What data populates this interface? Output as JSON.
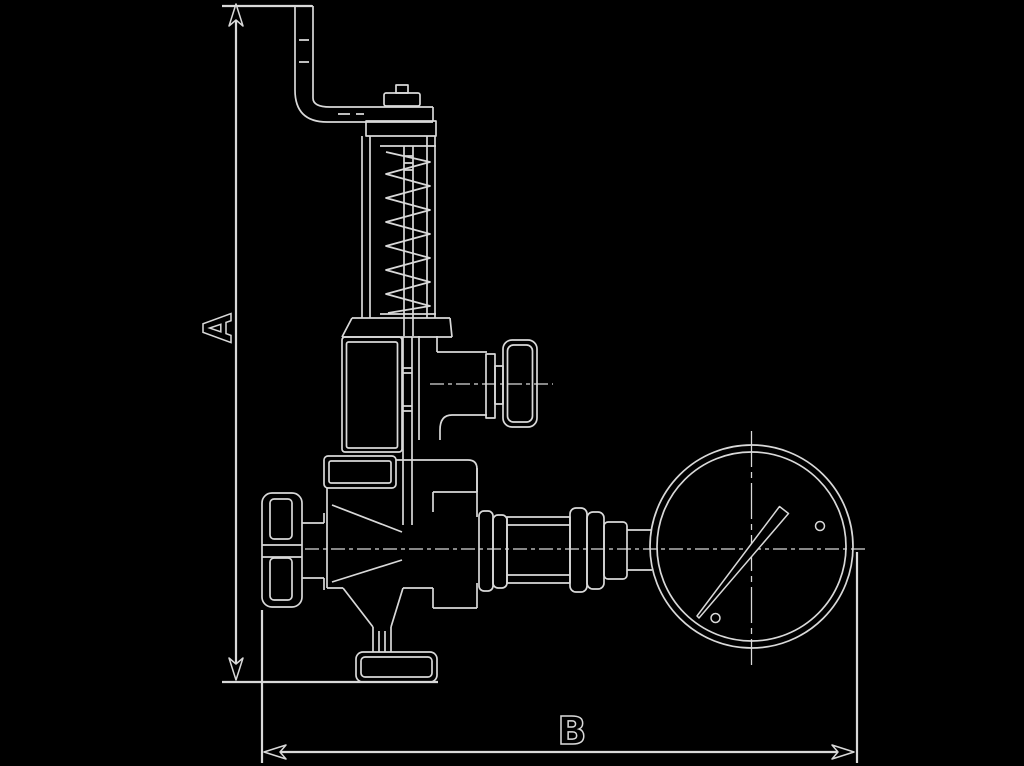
{
  "canvas": {
    "width": 1024,
    "height": 766,
    "background": "#000000",
    "line_color": "#d9d9d9"
  },
  "drawing": {
    "kind": "technical outline drawing",
    "subject": "spring-loaded overflow/safety valve with test lever, side shut-off knob, inlet handwheel and pressure gauge",
    "labels": {
      "dim_a": "A",
      "dim_b": "B"
    }
  }
}
